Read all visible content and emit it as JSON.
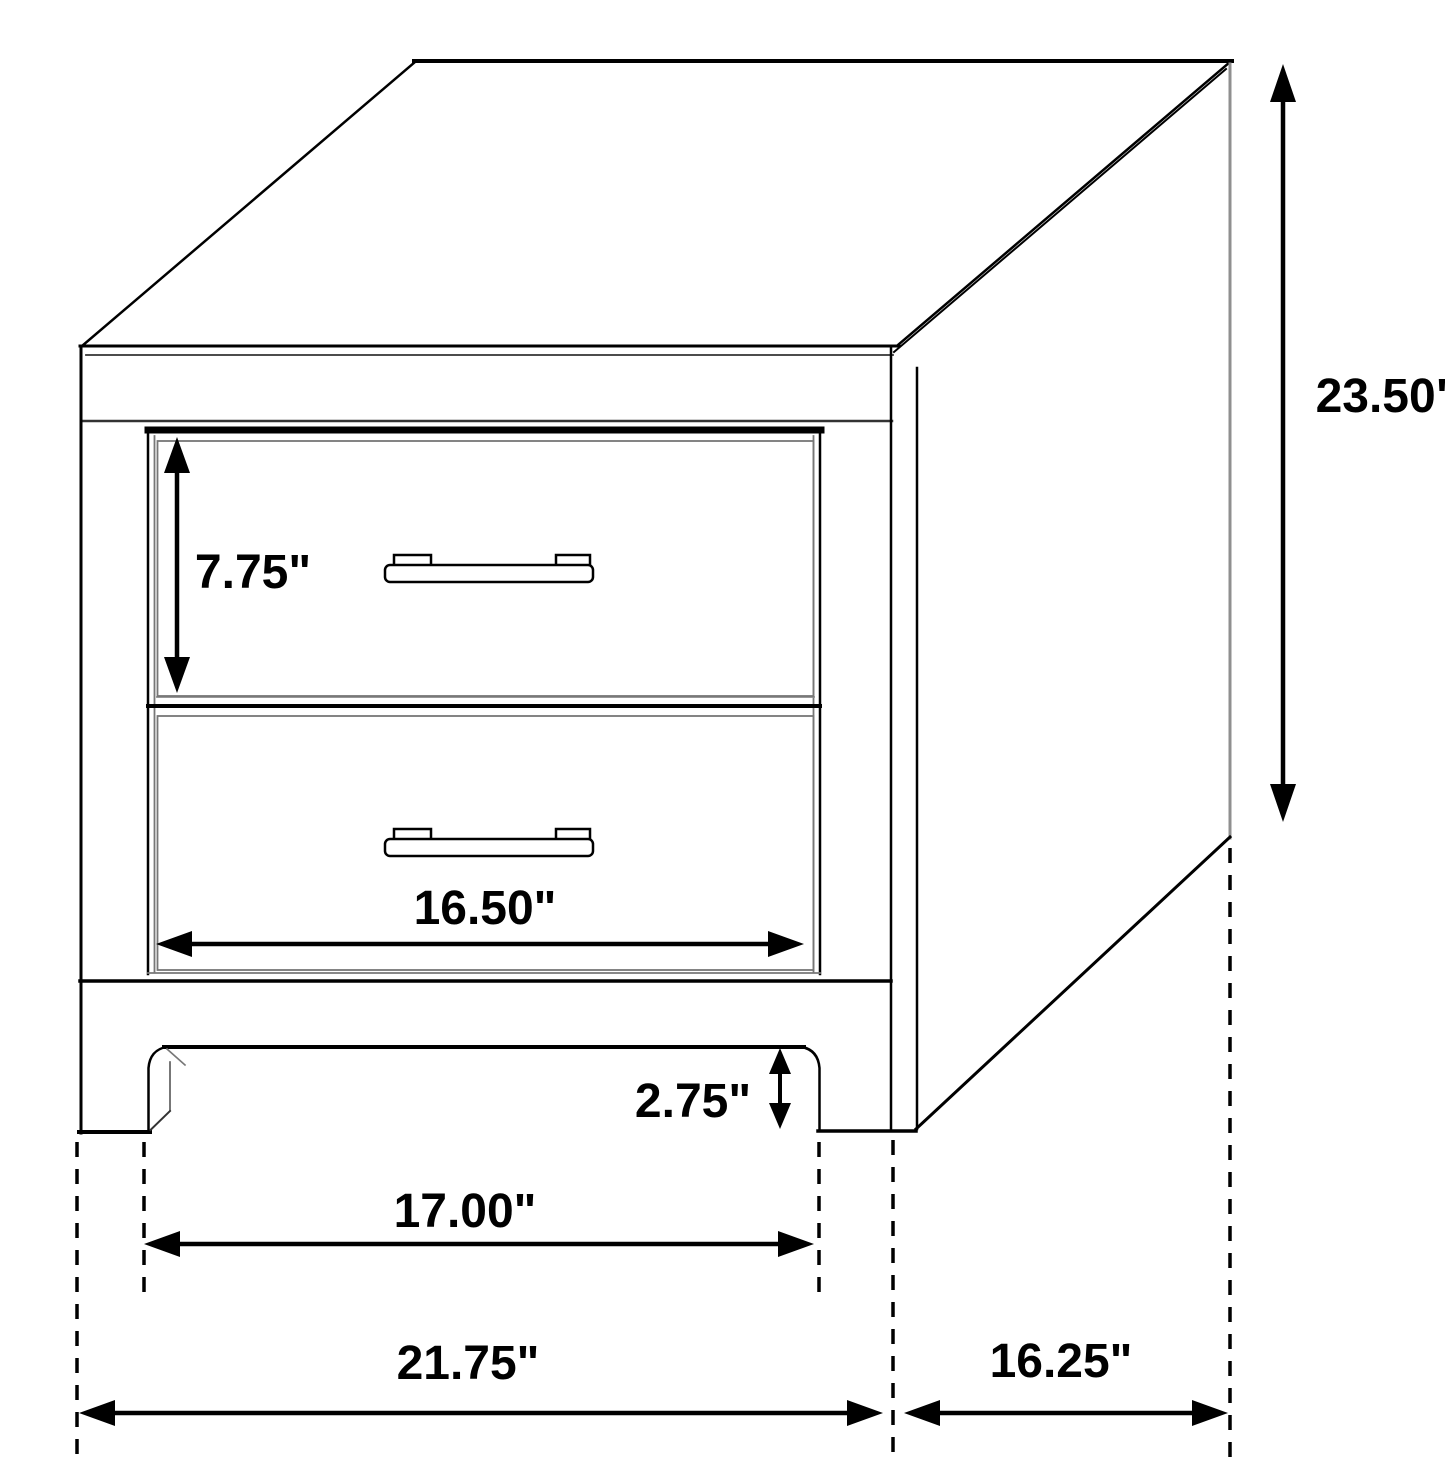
{
  "diagram": {
    "subject": "two-drawer nightstand dimension drawing",
    "background_color": "#ffffff",
    "line_color": "#000000",
    "dimensions": {
      "overall_height": "23.50\"",
      "top_drawer_height": "7.75\"",
      "drawer_width": "16.50\"",
      "foot_height": "2.75\"",
      "leg_inner_span": "17.00\"",
      "overall_width": "21.75\"",
      "overall_depth": "16.25\""
    }
  }
}
